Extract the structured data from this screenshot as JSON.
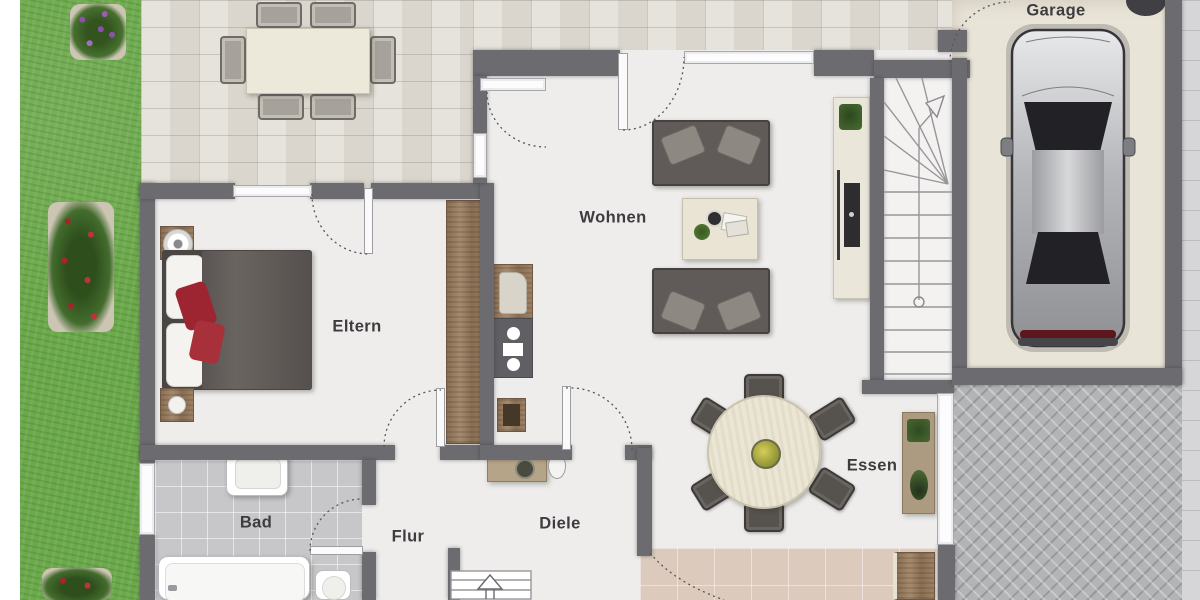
{
  "floor_plan": {
    "rooms": [
      {
        "id": "garage",
        "label": "Garage"
      },
      {
        "id": "wohnen",
        "label": "Wohnen"
      },
      {
        "id": "eltern",
        "label": "Eltern"
      },
      {
        "id": "essen",
        "label": "Essen"
      },
      {
        "id": "bad",
        "label": "Bad"
      },
      {
        "id": "flur",
        "label": "Flur"
      },
      {
        "id": "diele",
        "label": "Diele"
      }
    ],
    "colors": {
      "wall": "#6b6b70",
      "interior_floor": "#eeedeb",
      "terrace_tile": "#e2ded6",
      "grass": "#6ca94b",
      "garage_floor": "#e9e4d8",
      "entry_tile": "#dccbbd",
      "bath_tile": "#c7c7c9",
      "paver": "#b3b4b6",
      "wood": "#93765a",
      "sofa_gray": "#605b58",
      "accent_red": "#9c2531"
    },
    "furniture": [
      "outdoor-dining-set",
      "double-bed",
      "nightstand",
      "wardrobe",
      "kitchenette-unit",
      "sofa",
      "coffee-table",
      "tv-sideboard",
      "round-dining-table",
      "dining-chair",
      "sideboard",
      "washbasin",
      "bathtub",
      "toilet",
      "car",
      "main-staircase",
      "basement-stairs"
    ]
  }
}
